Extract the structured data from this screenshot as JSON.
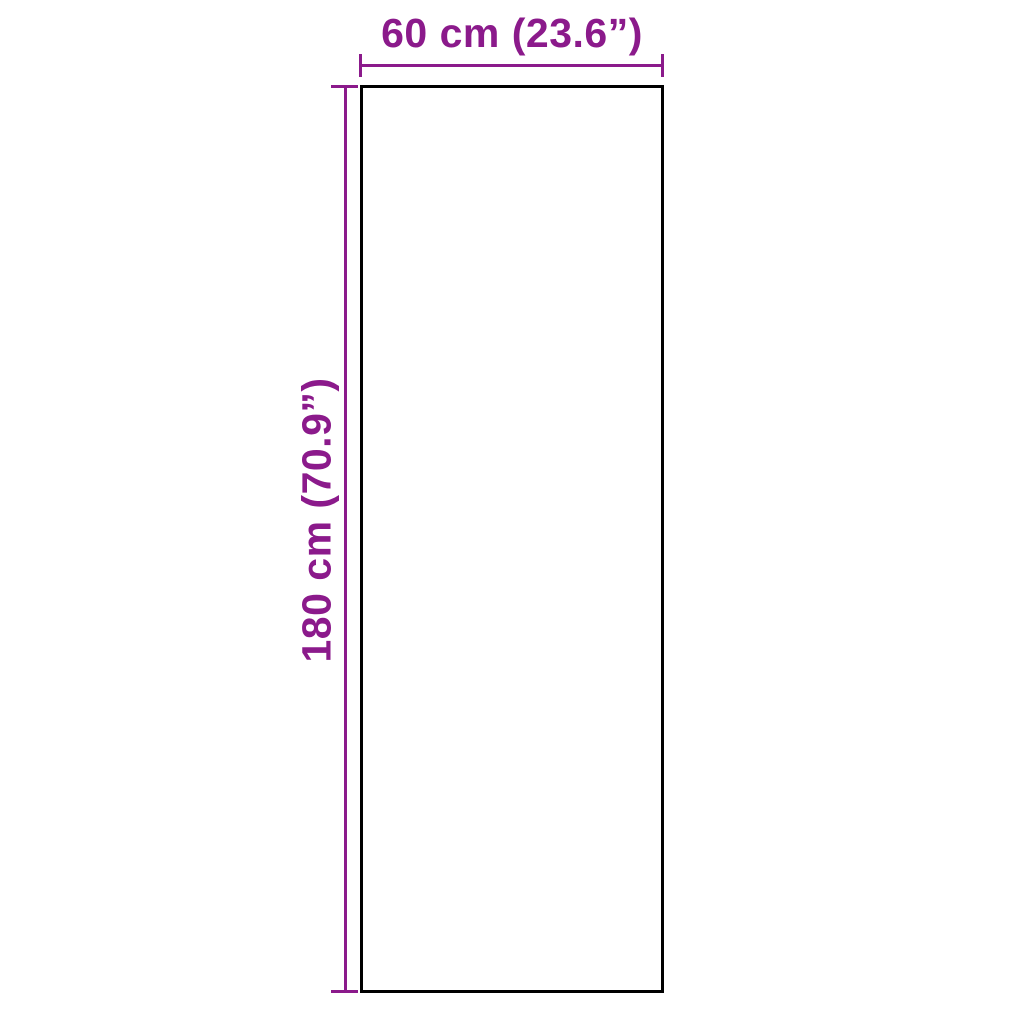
{
  "diagram": {
    "type": "product-dimension-diagram",
    "width_label": "60 cm (23.6”)",
    "height_label": "180 cm (70.9”)",
    "width_value_cm": 60,
    "width_value_inches": 23.6,
    "height_value_cm": 180,
    "height_value_inches": 70.9,
    "accent_color": "#8B1A8B",
    "outline_color": "#000000",
    "background_color": "#FFFFFF"
  }
}
